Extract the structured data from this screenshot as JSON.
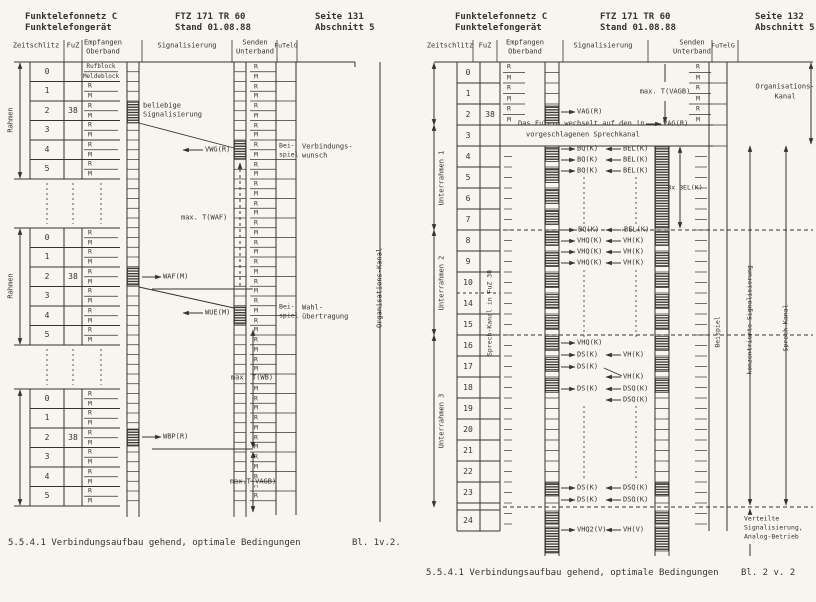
{
  "pages": [
    {
      "header": {
        "left1": "Funktelefonnetz C",
        "left2": "Funktelefongerät",
        "mid1": "FTZ 171 TR 60",
        "mid2": "Stand 01.08.88",
        "right1": "Seite 131",
        "right2": "Abschnitt 5"
      },
      "caption": "5.5.4.1 Verbindungsaufbau gehend, optimale Bedingungen",
      "sheet": "Bl. 1v.2."
    },
    {
      "header": {
        "left1": "Funktelefonnetz C",
        "left2": "Funktelefongerät",
        "mid1": "FTZ 171 TR 60",
        "mid2": "Stand 01.08.88",
        "right1": "Seite 132",
        "right2": "Abschnitt 5"
      },
      "caption": "5.5.4.1 Verbindungsaufbau gehend, optimale Bedingungen",
      "sheet": "Bl. 2 v. 2"
    }
  ],
  "columns": {
    "zeitschlitz": "Zeitschlitz",
    "fuz": "FuZ",
    "empfangen": [
      "Empfangen",
      "Oberband"
    ],
    "signalisierung": "Signalisierung",
    "senden": [
      "Senden",
      "Unterband"
    ],
    "futelg": "FuTelG"
  },
  "cells": {
    "r": "R",
    "m": "M"
  },
  "left_diagram": {
    "frame_label": "Rahmen",
    "slots": [
      "0",
      "1",
      "2",
      "3",
      "4",
      "5"
    ],
    "fuz_value": "38",
    "slot0_cells": [
      "Rufblock",
      "Meldeblock"
    ],
    "beliebige": [
      "beliebige",
      "Signalisierung"
    ],
    "vwg": "VWG(R)",
    "waf": "WAF(M)",
    "wue": "WUE(M)",
    "wbp": "WBP(R)",
    "beispiel": [
      "Bei-",
      "spiel"
    ],
    "verbindungswunsch": [
      "Verbindungs-",
      "wunsch"
    ],
    "wahluebertragung": [
      "Wahl-",
      "übertragung"
    ],
    "t_waf": "max. T(WAF)",
    "t_wb": "max. T(WB)",
    "t_vagb": "max.T(VAGB)",
    "org_kanal": "Organisations-Kanal"
  },
  "right_diagram": {
    "rows": [
      "0",
      "1",
      "2",
      "3",
      "4",
      "5",
      "6",
      "7",
      "8",
      "9",
      "10",
      "14",
      "15",
      "16",
      "17",
      "18",
      "19",
      "20",
      "21",
      "22",
      "23",
      "24"
    ],
    "fuz_value": "38",
    "underframes": [
      "Unterrahmen 1",
      "Unterrahmen 2",
      "Unterrahmen 3"
    ],
    "fuz_channel": "Sprech-Kanal in FuZ 38",
    "wechsel": [
      "Das FuTelG wechselt auf den in",
      "vorgeschlagenen Sprechkanal"
    ],
    "wechsel_signal": "VAG(R)",
    "t_vagb": "max. T(VAGB)",
    "org_kanal": [
      "Organisations-",
      "Kanal"
    ],
    "bel8": "8x BEL(K)",
    "beispiel": "Beispiel",
    "konzentrierte": "konzentrierte Signalisierung",
    "sprech_kanal": "Sprech-Kanal",
    "verteilte": [
      "Verteilte",
      "Signalisierung,",
      "Analog-Betrieb"
    ],
    "signals": [
      {
        "y": 112,
        "out": "VAG(R)"
      },
      {
        "y": 149,
        "out": "BQ(K)",
        "in": "BEL(K)"
      },
      {
        "y": 160,
        "out": "BQ(K)",
        "in": "BEL(K)"
      },
      {
        "y": 171,
        "out": "BQ(K)",
        "in": "BEL(K)"
      },
      {
        "y": 230,
        "out": "BQ(K)",
        "in": "BEL(K)",
        "bg": true
      },
      {
        "y": 241,
        "out": "VHQ(K)",
        "in": "VH(K)"
      },
      {
        "y": 252,
        "out": "VHQ(K)",
        "in": "VH(K)"
      },
      {
        "y": 263,
        "out": "VHQ(K)",
        "in": "VH(K)"
      },
      {
        "y": 343,
        "out": "VHQ(K)"
      },
      {
        "y": 355,
        "out": "DS(K)",
        "in": "VH(K)"
      },
      {
        "y": 367,
        "out": "DS(K)",
        "diag": true
      },
      {
        "y": 377,
        "in": "VH(K)"
      },
      {
        "y": 389,
        "out": "DS(K)",
        "in": "DSQ(K)"
      },
      {
        "y": 400,
        "in": "DSQ(K)"
      },
      {
        "y": 488,
        "out": "DS(K)",
        "in": "DSQ(K)"
      },
      {
        "y": 500,
        "out": "DS(K)",
        "in": "DSQ(K)"
      },
      {
        "y": 530,
        "out": "VHQ2(V)",
        "in": "VH(V)"
      }
    ]
  }
}
